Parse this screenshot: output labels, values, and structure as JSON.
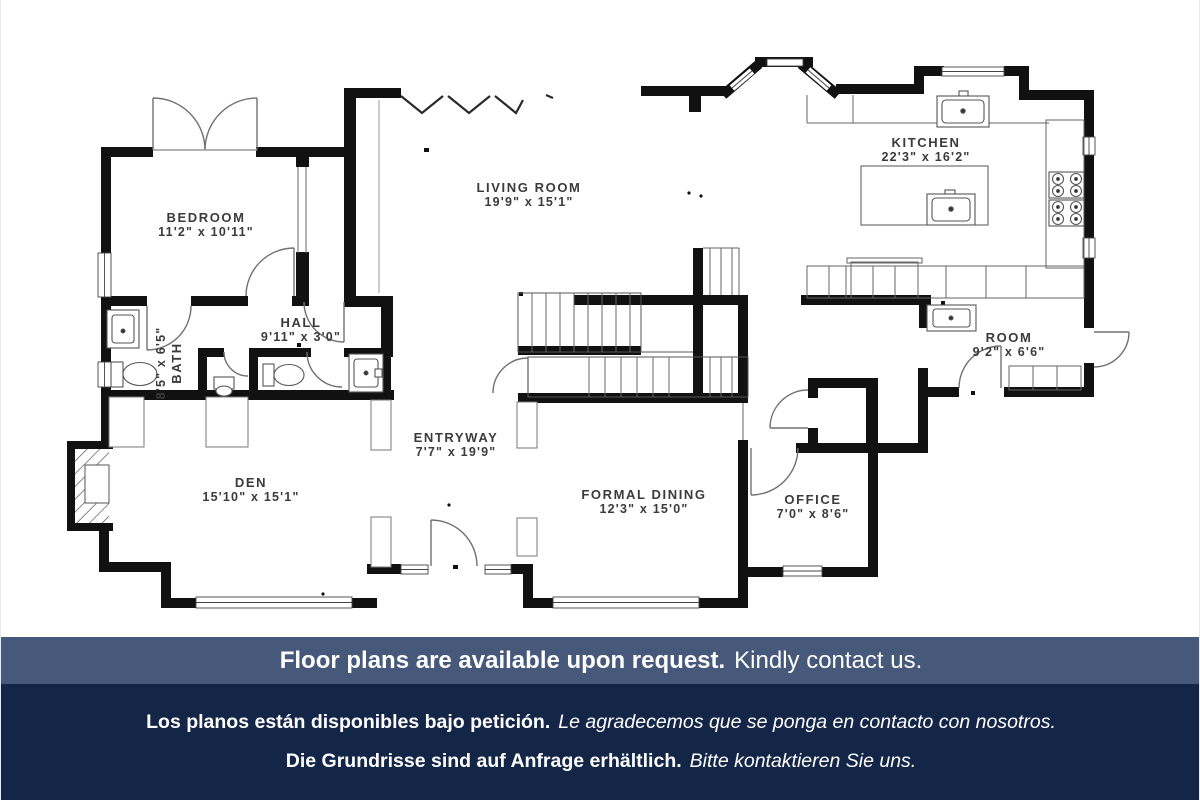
{
  "plan": {
    "rooms": [
      {
        "id": "bedroom",
        "name": "BEDROOM",
        "dims": "11'2\" x 10'11\""
      },
      {
        "id": "living",
        "name": "LIVING ROOM",
        "dims": "19'9\" x 15'1\""
      },
      {
        "id": "kitchen",
        "name": "KITCHEN",
        "dims": "22'3\" x 16'2\""
      },
      {
        "id": "hall",
        "name": "HALL",
        "dims": "9'11\" x 3'0\""
      },
      {
        "id": "bath",
        "name": "BATH",
        "dims": "8'5\" x 6'5\""
      },
      {
        "id": "room",
        "name": "ROOM",
        "dims": "9'2\" x 6'6\""
      },
      {
        "id": "den",
        "name": "DEN",
        "dims": "15'10\" x 15'1\""
      },
      {
        "id": "entryway",
        "name": "ENTRYWAY",
        "dims": "7'7\" x 19'9\""
      },
      {
        "id": "dining",
        "name": "FORMAL DINING",
        "dims": "12'3\" x 15'0\""
      },
      {
        "id": "office",
        "name": "OFFICE",
        "dims": "7'0\" x 8'6\""
      }
    ],
    "wall_color": "#111111",
    "label_color": "#3b3b3b"
  },
  "footer": {
    "en_bold": "Floor plans are available upon request.",
    "en_regular": "Kindly contact us.",
    "es_bold": "Los planos están disponibles bajo petición.",
    "es_italic": "Le agradecemos que se ponga en contacto con nosotros.",
    "de_bold": "Die Grundrisse sind auf Anfrage erhältlich.",
    "de_italic": "Bitte kontaktieren Sie uns.",
    "bar1_bg": "#46597b",
    "bar2_bg": "#142647",
    "text_color": "#ffffff"
  }
}
